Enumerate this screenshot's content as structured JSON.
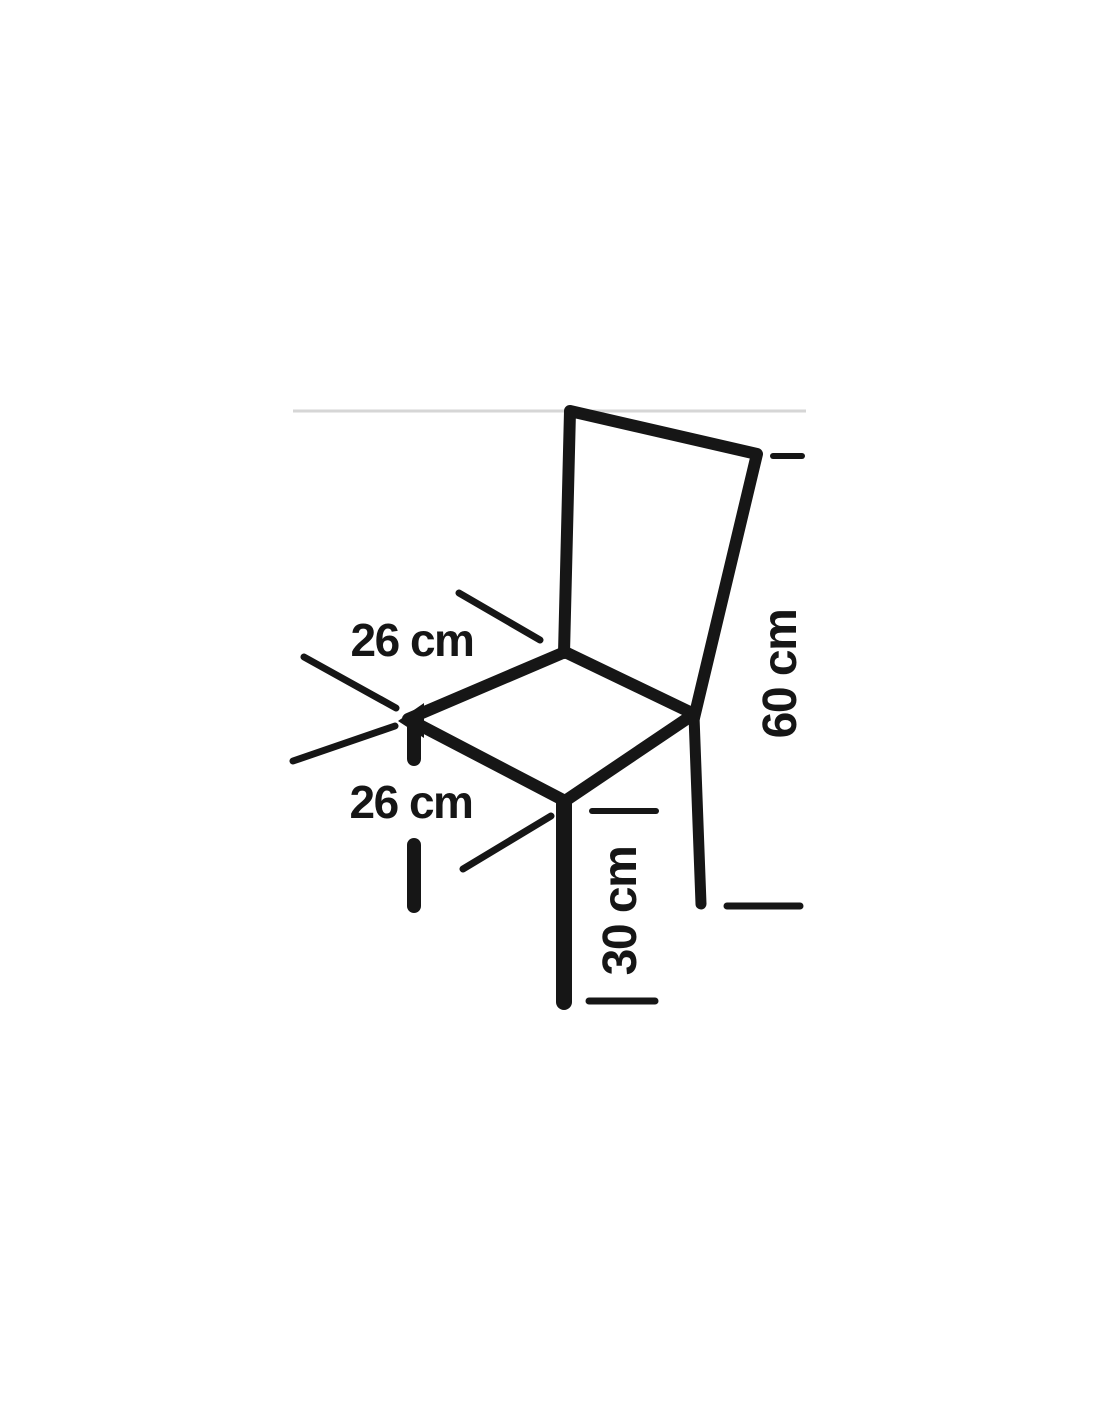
{
  "figure": {
    "title": "chair-dimensions-diagram",
    "labels": {
      "seat_width": "26 cm",
      "seat_depth": "26 cm",
      "back_height": "60 cm",
      "leg_height": "30 cm"
    },
    "dimensions_cm": {
      "seat_width": 26,
      "seat_depth": 26,
      "back_height": 60,
      "leg_height": 30
    },
    "colors": {
      "line": "#161616",
      "border_line": "#d6d6d6",
      "background": "#ffffff"
    }
  }
}
